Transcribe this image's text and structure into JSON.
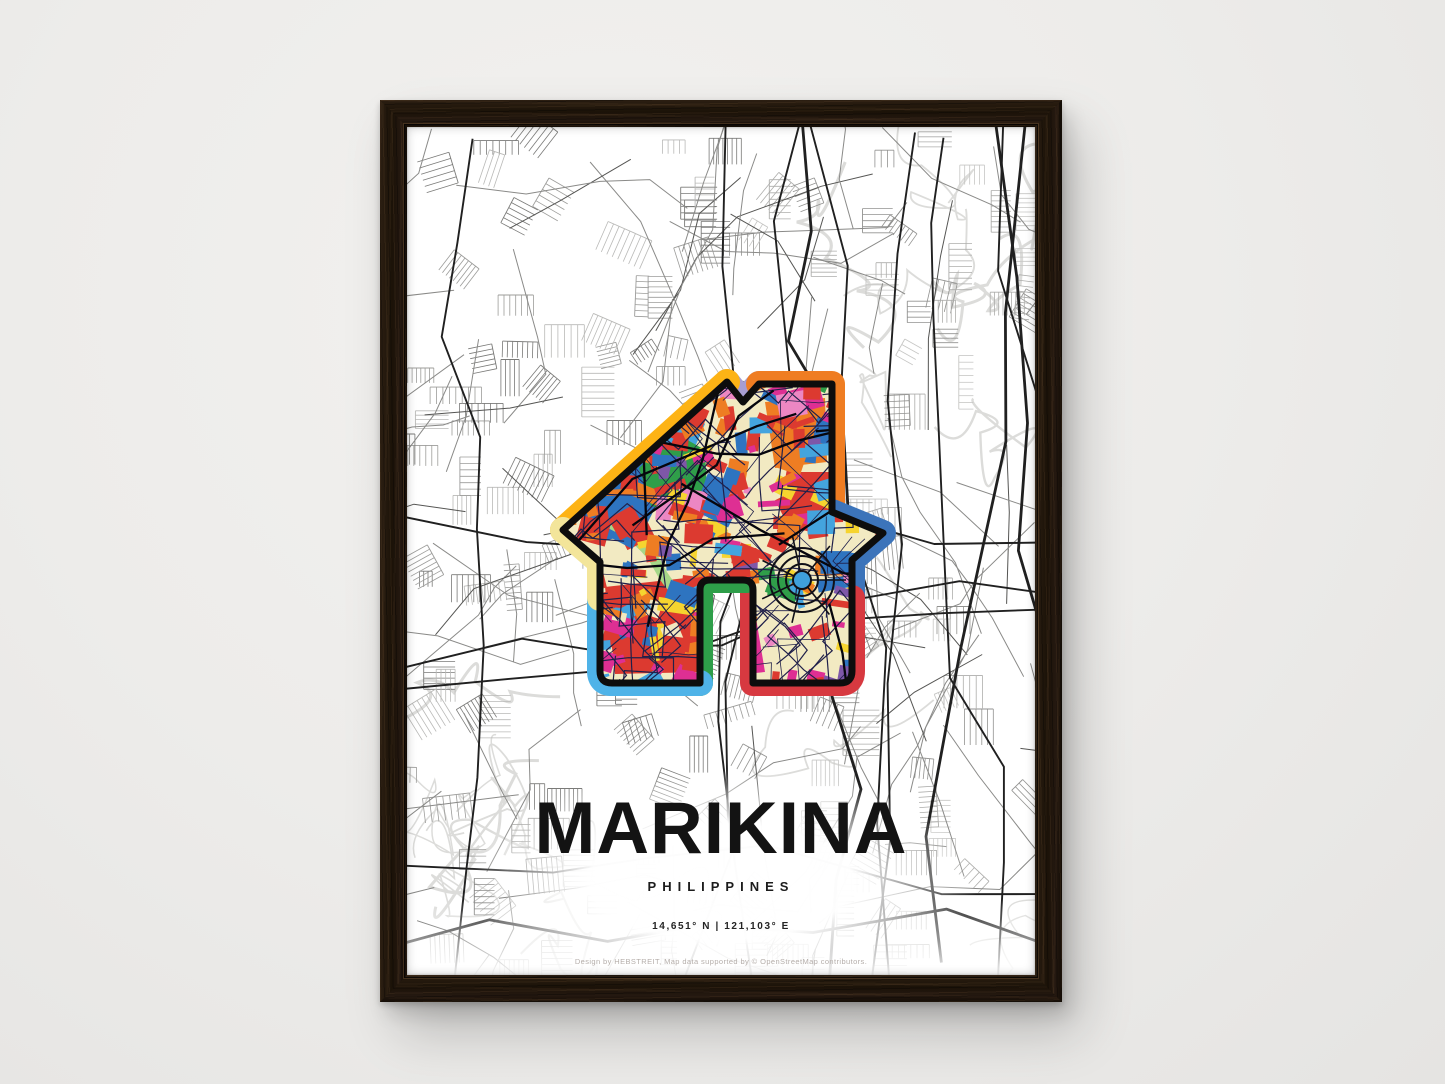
{
  "poster": {
    "title": "MARIKINA",
    "subtitle": "PHILIPPINES",
    "coordinates": "14,651° N | 121,103° E",
    "credit": "Design by HEBSTREIT, Map data supported by © OpenStreetMap contributors.",
    "house_icon": {
      "icon_name": "house-map-icon",
      "band_colors": {
        "pale_yellow": "#F3E59A",
        "gold": "#FDB315",
        "lavender": "#A79DD2",
        "orange": "#EF7D22",
        "blue": "#3C74BA",
        "red": "#D73940",
        "green": "#2E9E49",
        "sky_blue": "#4FB3E8"
      },
      "interior_palette": [
        "#DC3A30",
        "#EE7D23",
        "#2E74C0",
        "#44A4DE",
        "#DE2F93",
        "#EC87C3",
        "#F6D42F",
        "#F2E8C0",
        "#2F9E49",
        "#7E57A8"
      ],
      "interior_base": "#F2EAC2",
      "interior_street": "#20204A",
      "interior_major_street": "#06060D",
      "outline_color": "#0D0D0D",
      "water_color": "#3FA0DC",
      "river_ribbon": "#A6D788"
    },
    "base_map": {
      "minor_street_left": [
        "#b9b9b7",
        "#9c9c9a",
        "#7a7a78"
      ],
      "minor_street_right": [
        "#c6c6c4",
        "#adadab",
        "#929290"
      ],
      "medium_street": "#8a8a88",
      "major_road": "#202020",
      "contour": "#dcdcda"
    },
    "text_colors": {
      "title": "#131313",
      "credit": "#b5aeaa"
    }
  },
  "scene": {
    "wall_color": "#edecea",
    "frame_wood_color": "#211609"
  }
}
